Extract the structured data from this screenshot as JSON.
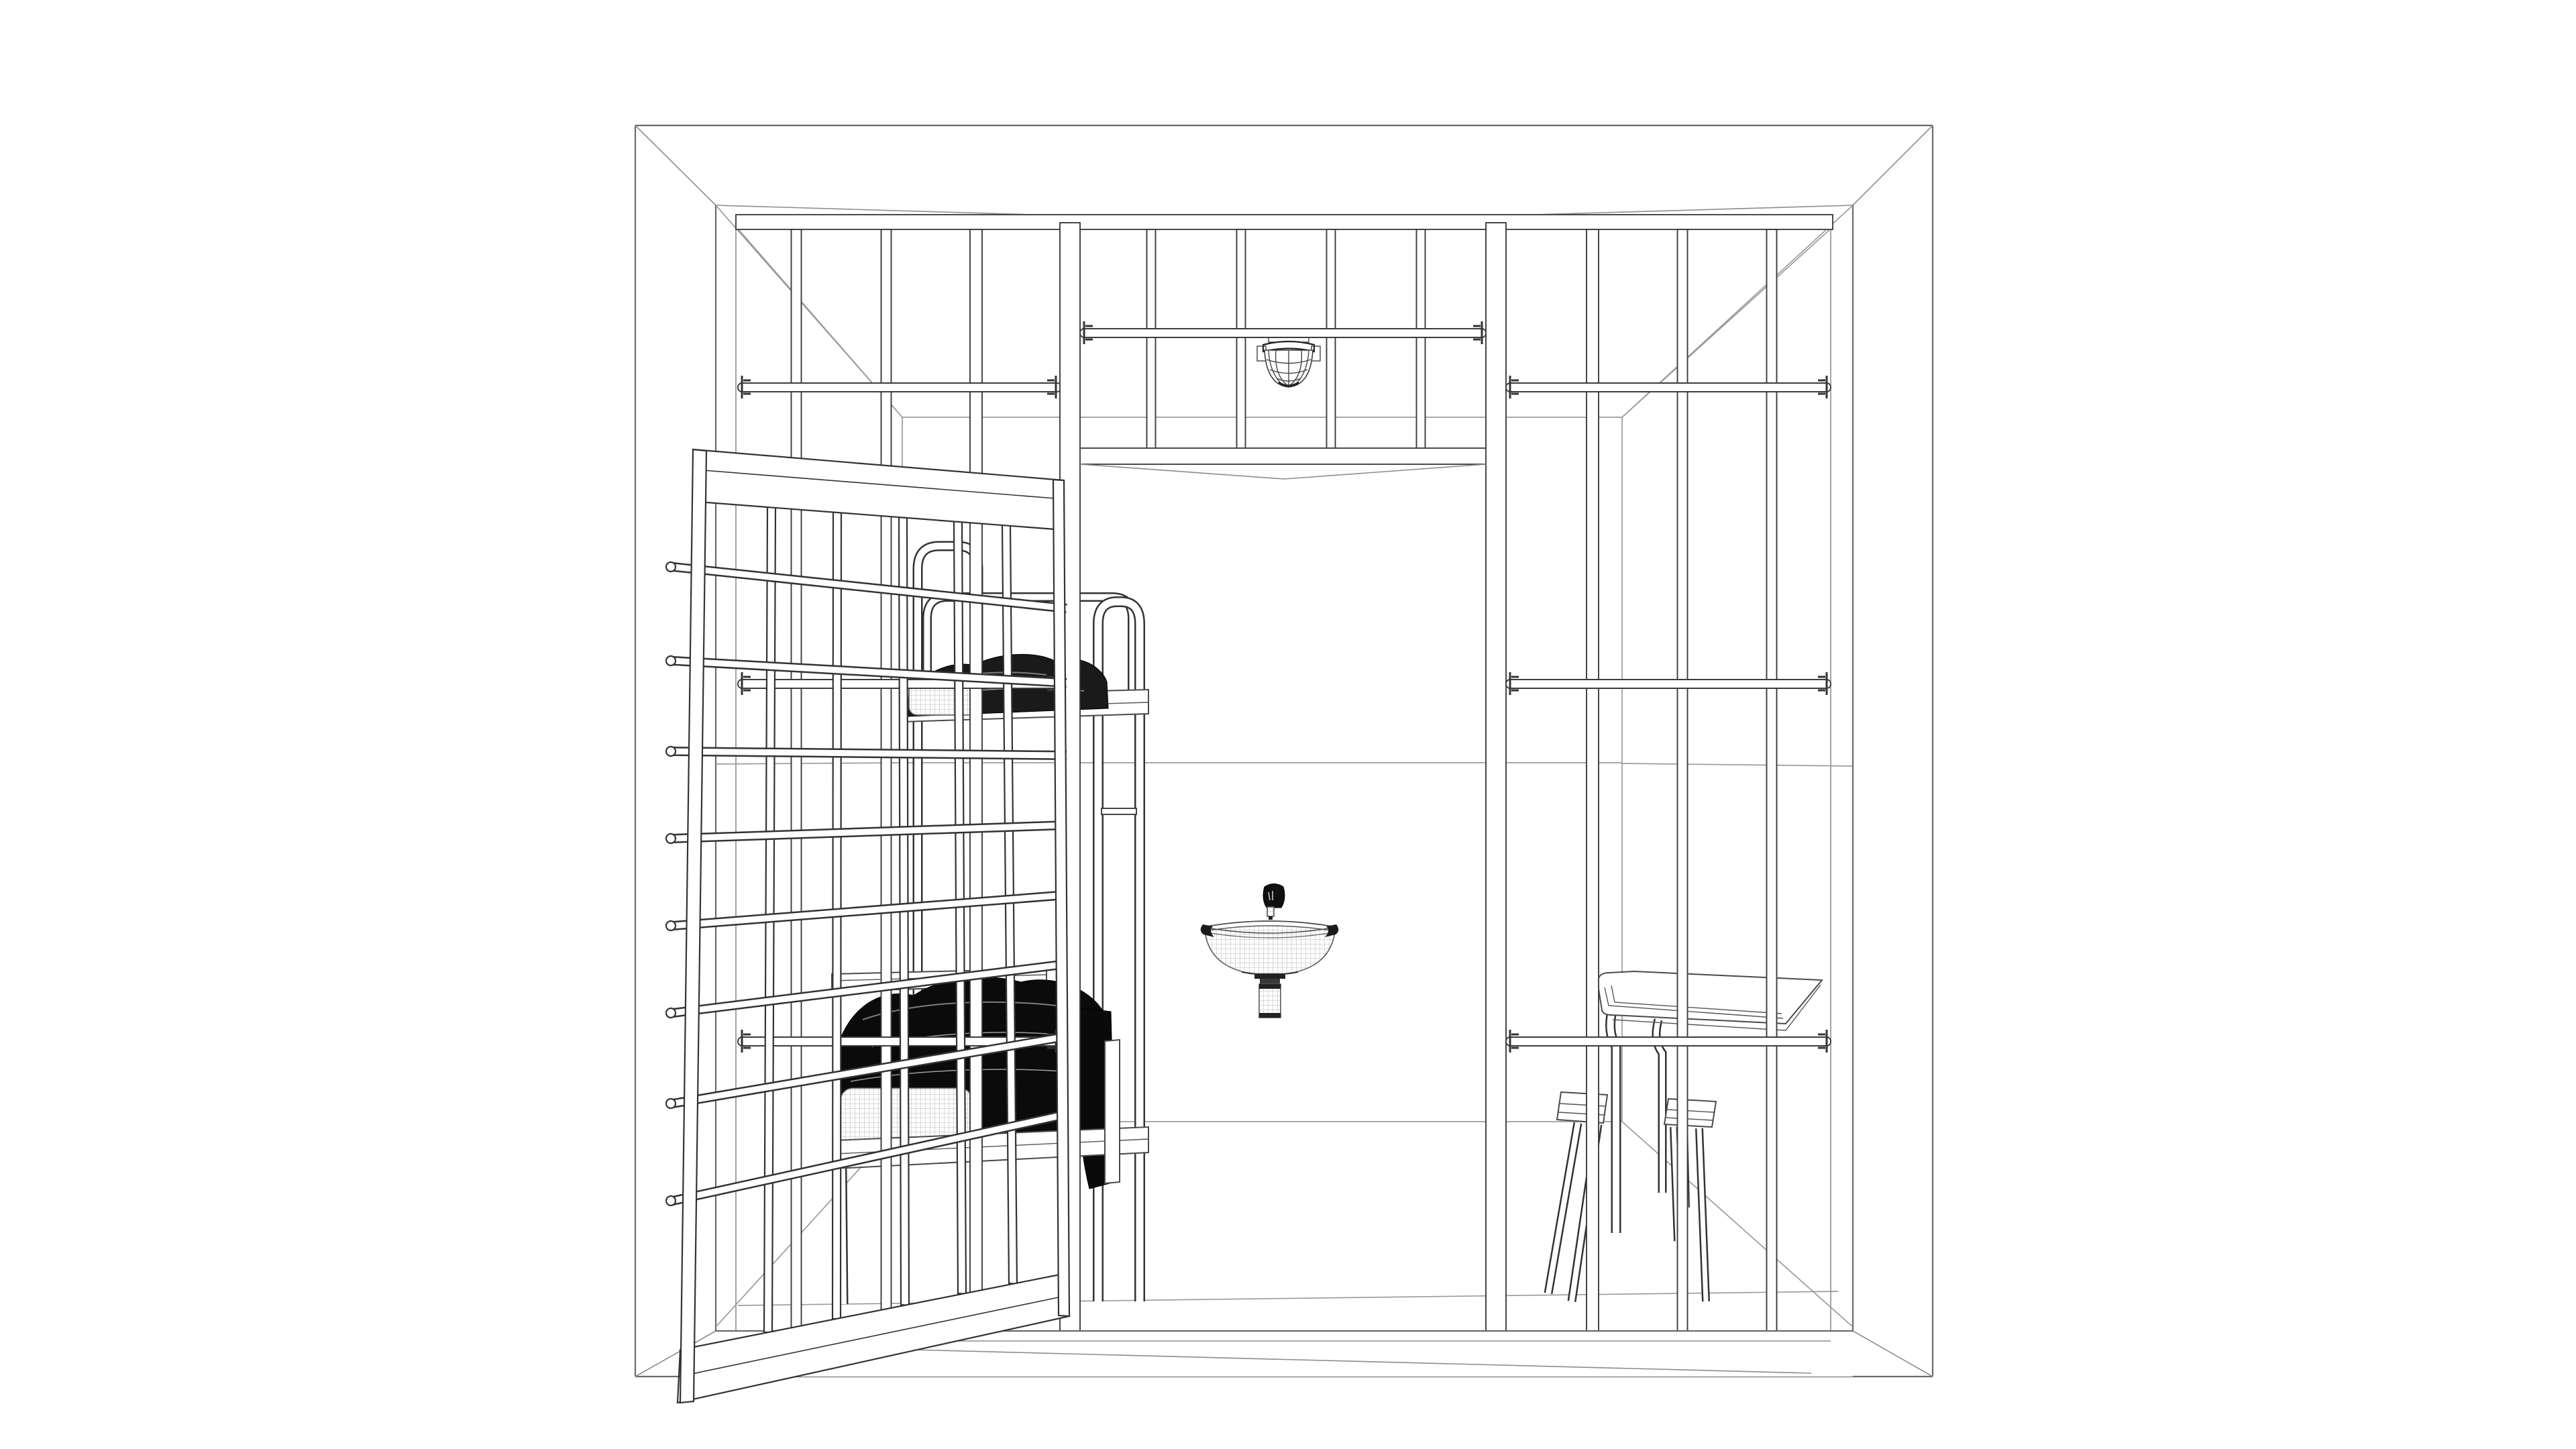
{
  "scene": {
    "title": "Prison cell wireframe render",
    "description": "Monochrome 3D wireframe line rendering of a jail cell: wall of vertical steel bars with three panels and a barred transom, an open barred door swung outward to the left, and inside the cell a bunk bed with dark rumpled blankets and light mesh pillows, a wall-mounted half-round sink with faucet and drain pipe, a caged dome ceiling lamp, and a small table with two stools on the right.",
    "style": "technical wireframe line drawing on white",
    "colors": {
      "background": "#ffffff",
      "primary_line": "#3c3c3c",
      "wall_line": "#6a6a6a",
      "interior_line": "#9b9b9b",
      "blanket_dark": "#101010",
      "blanket_upper": "#1a1a1a"
    },
    "objects": [
      {
        "name": "outer-wall",
        "label": "Front wall with large barred opening"
      },
      {
        "name": "bars-left-panel",
        "label": "Left fixed bar panel"
      },
      {
        "name": "bars-transom",
        "label": "Barred transom above doorway"
      },
      {
        "name": "bars-right-panel",
        "label": "Right fixed bar panel"
      },
      {
        "name": "cell-door",
        "label": "Open barred cell door"
      },
      {
        "name": "bunk-bed",
        "label": "Bunk bed with blankets and pillows"
      },
      {
        "name": "sink",
        "label": "Wall-mounted sink with faucet and trap"
      },
      {
        "name": "ceiling-lamp",
        "label": "Caged dome ceiling light"
      },
      {
        "name": "table",
        "label": "Table"
      },
      {
        "name": "stool-left",
        "label": "Tilted stool"
      },
      {
        "name": "stool-right",
        "label": "Stool"
      }
    ]
  }
}
